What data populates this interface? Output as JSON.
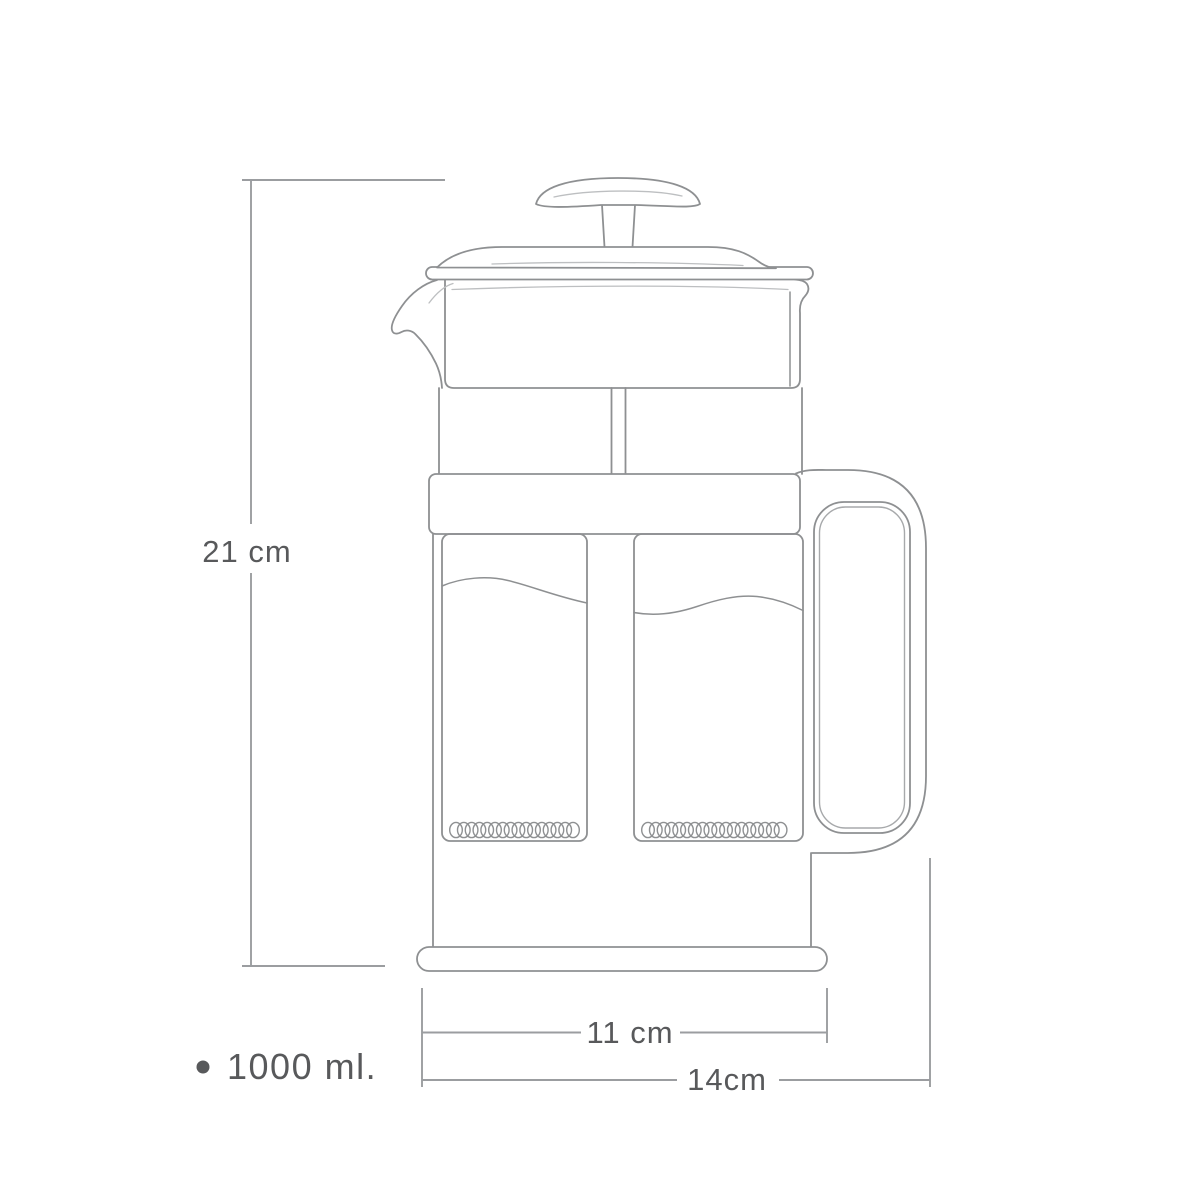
{
  "labels": {
    "height": "21 cm",
    "base_width": "11 cm",
    "total_width": "14cm",
    "capacity": "1000 ml."
  },
  "colors": {
    "drawing_line": "#8e9092",
    "accent_line": "#bdbfc1",
    "dimension_line": "#9b9da0",
    "text": "#58595b",
    "background": "#ffffff"
  }
}
